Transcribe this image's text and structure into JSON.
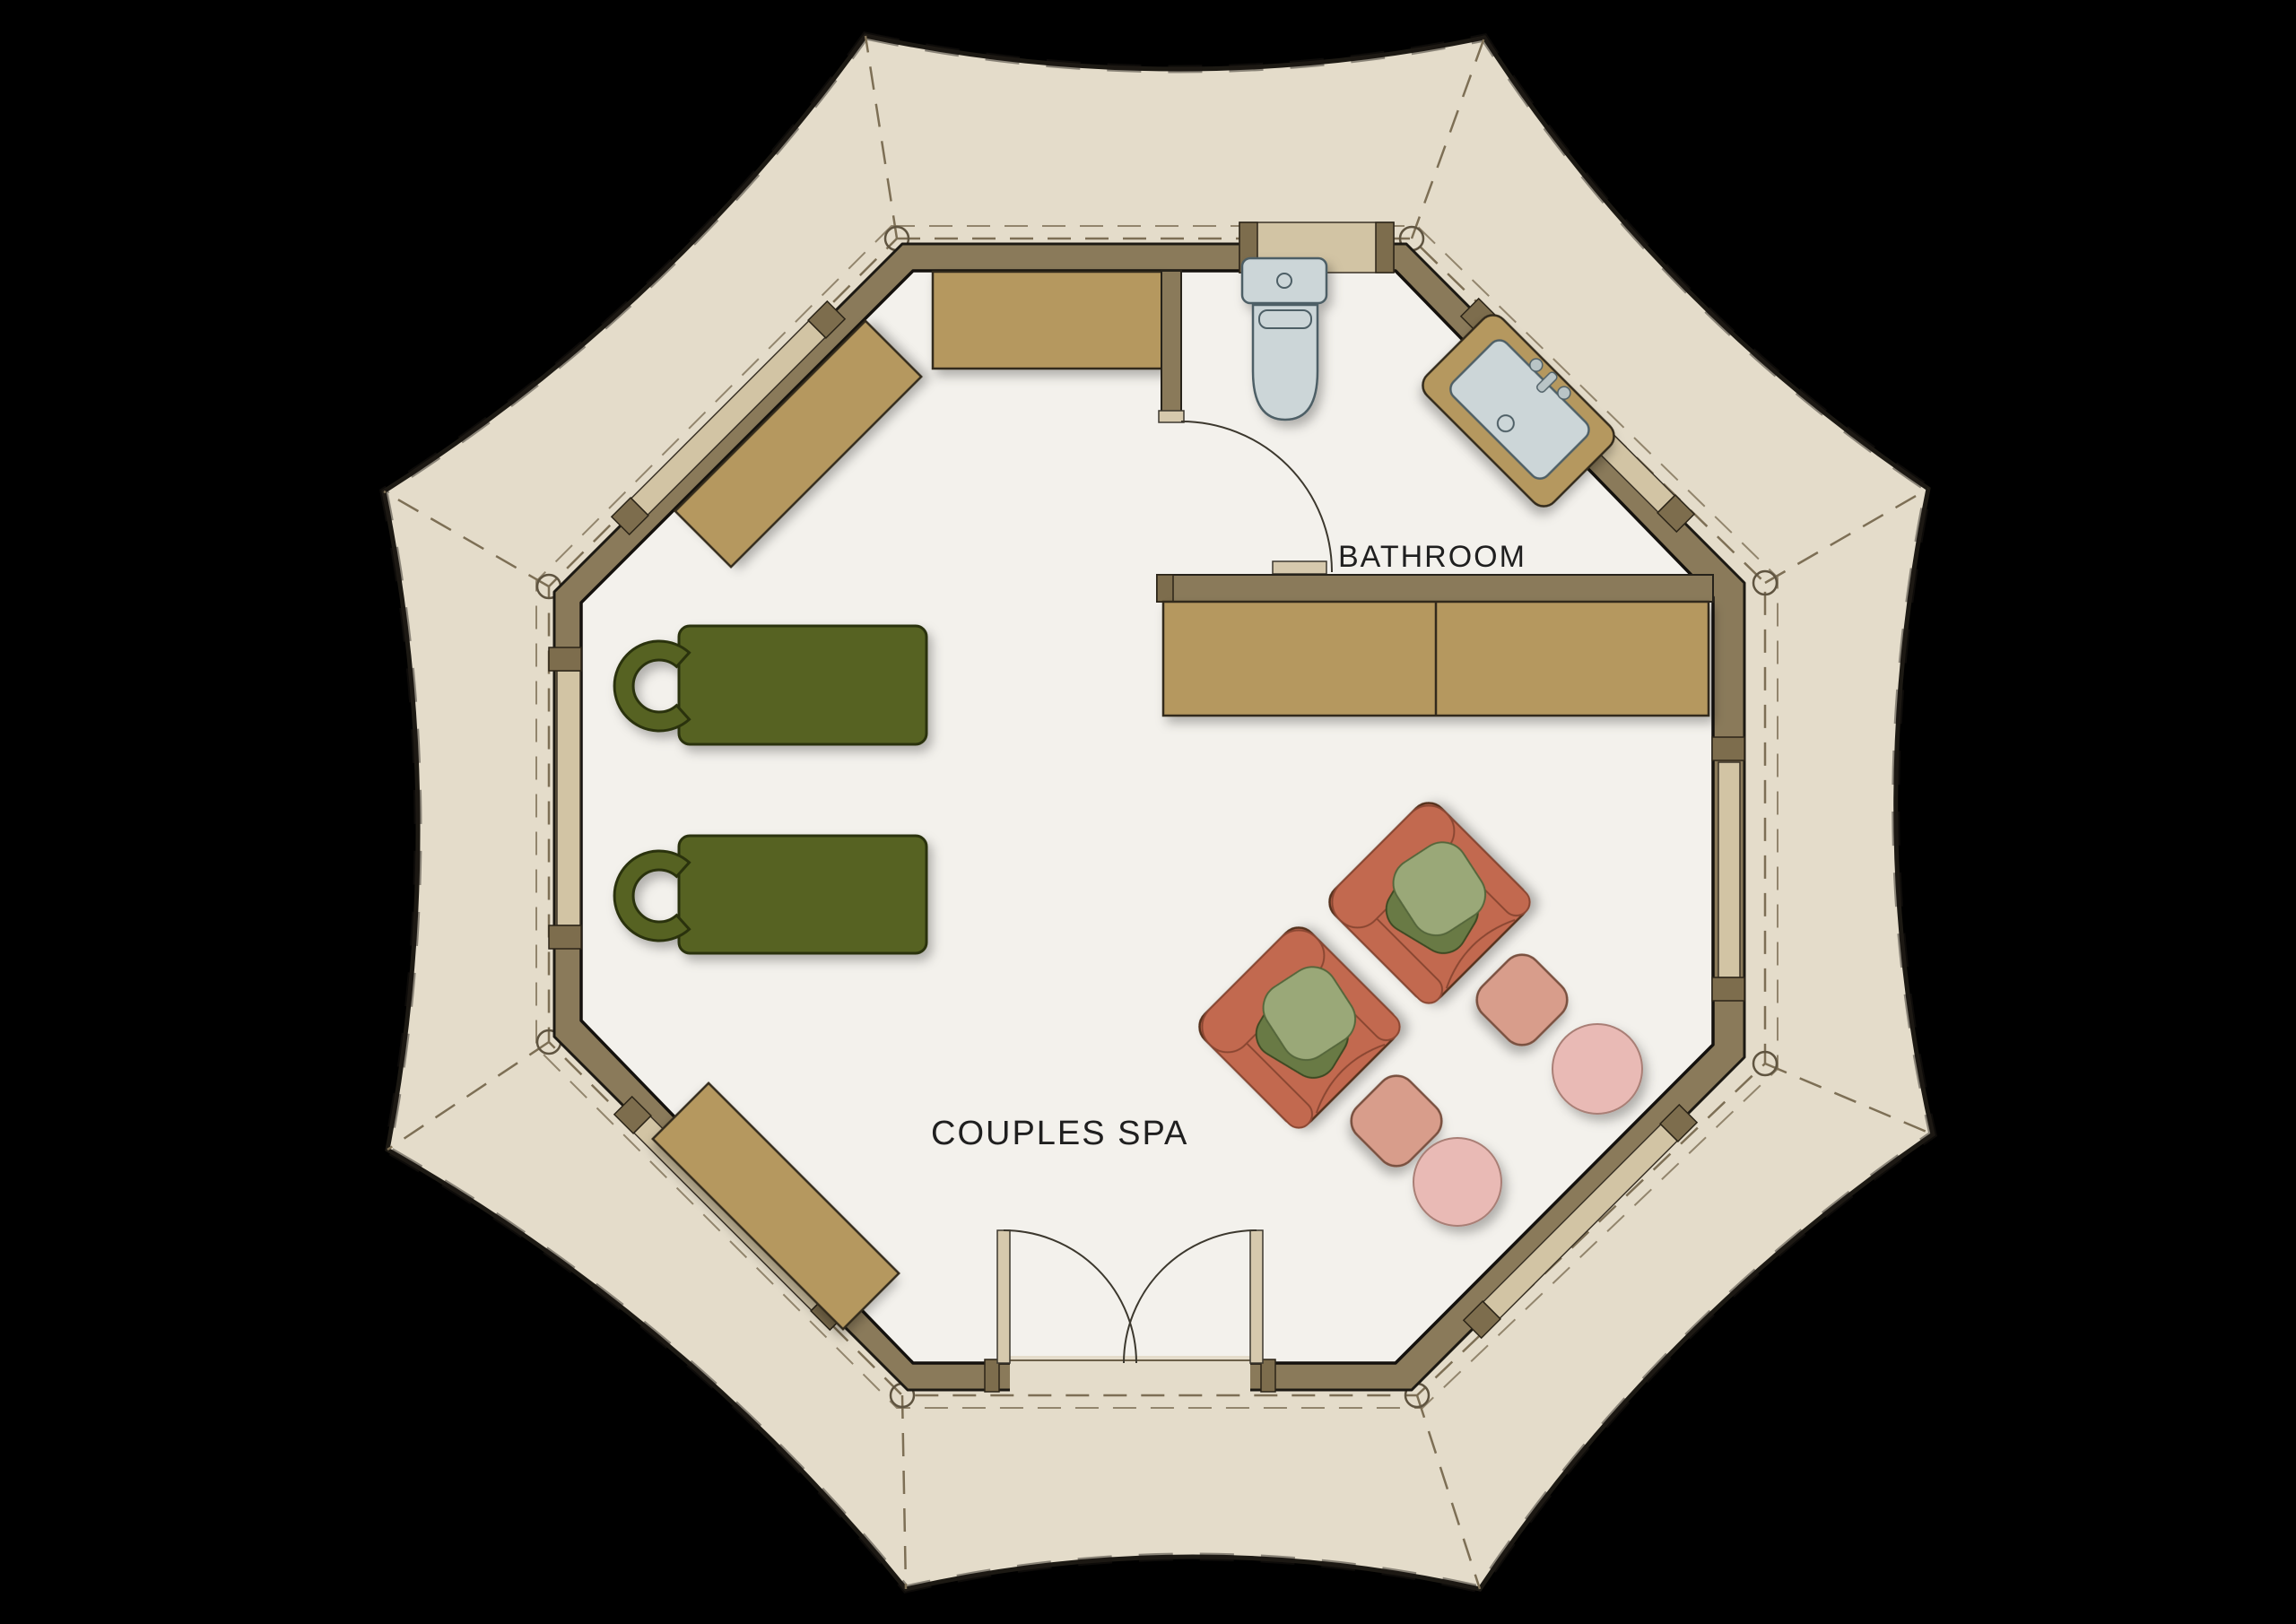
{
  "labels": {
    "bathroom": "BATHROOM",
    "couples_spa": "COUPLES SPA"
  },
  "colors": {
    "bg": "#000000",
    "canvas": "#e4dcca",
    "outline": "#1c1913",
    "seam": "#7d6f55",
    "wall": "#8a7a5a",
    "floor": "#f3f1ec",
    "wood": "#b5985f",
    "wood-dark": "#7d6d4d",
    "window": "#d2c4a4",
    "jamb": "#d6c9ad",
    "table-green": "#566220",
    "table-green-stroke": "#2b330e",
    "terracotta": "#c2694f",
    "terracotta-stroke": "#55301f",
    "blanket-light": "#9aa878",
    "blanket-dark": "#697a45",
    "pouf": "#d89d8b",
    "pouf-stroke": "#7a5140",
    "pink": "#e9bab5",
    "pink-stroke": "#a97f76",
    "fixture": "#ccd6d8",
    "fixture-stroke": "#4e5f66",
    "ink": "#1f1f1f"
  }
}
